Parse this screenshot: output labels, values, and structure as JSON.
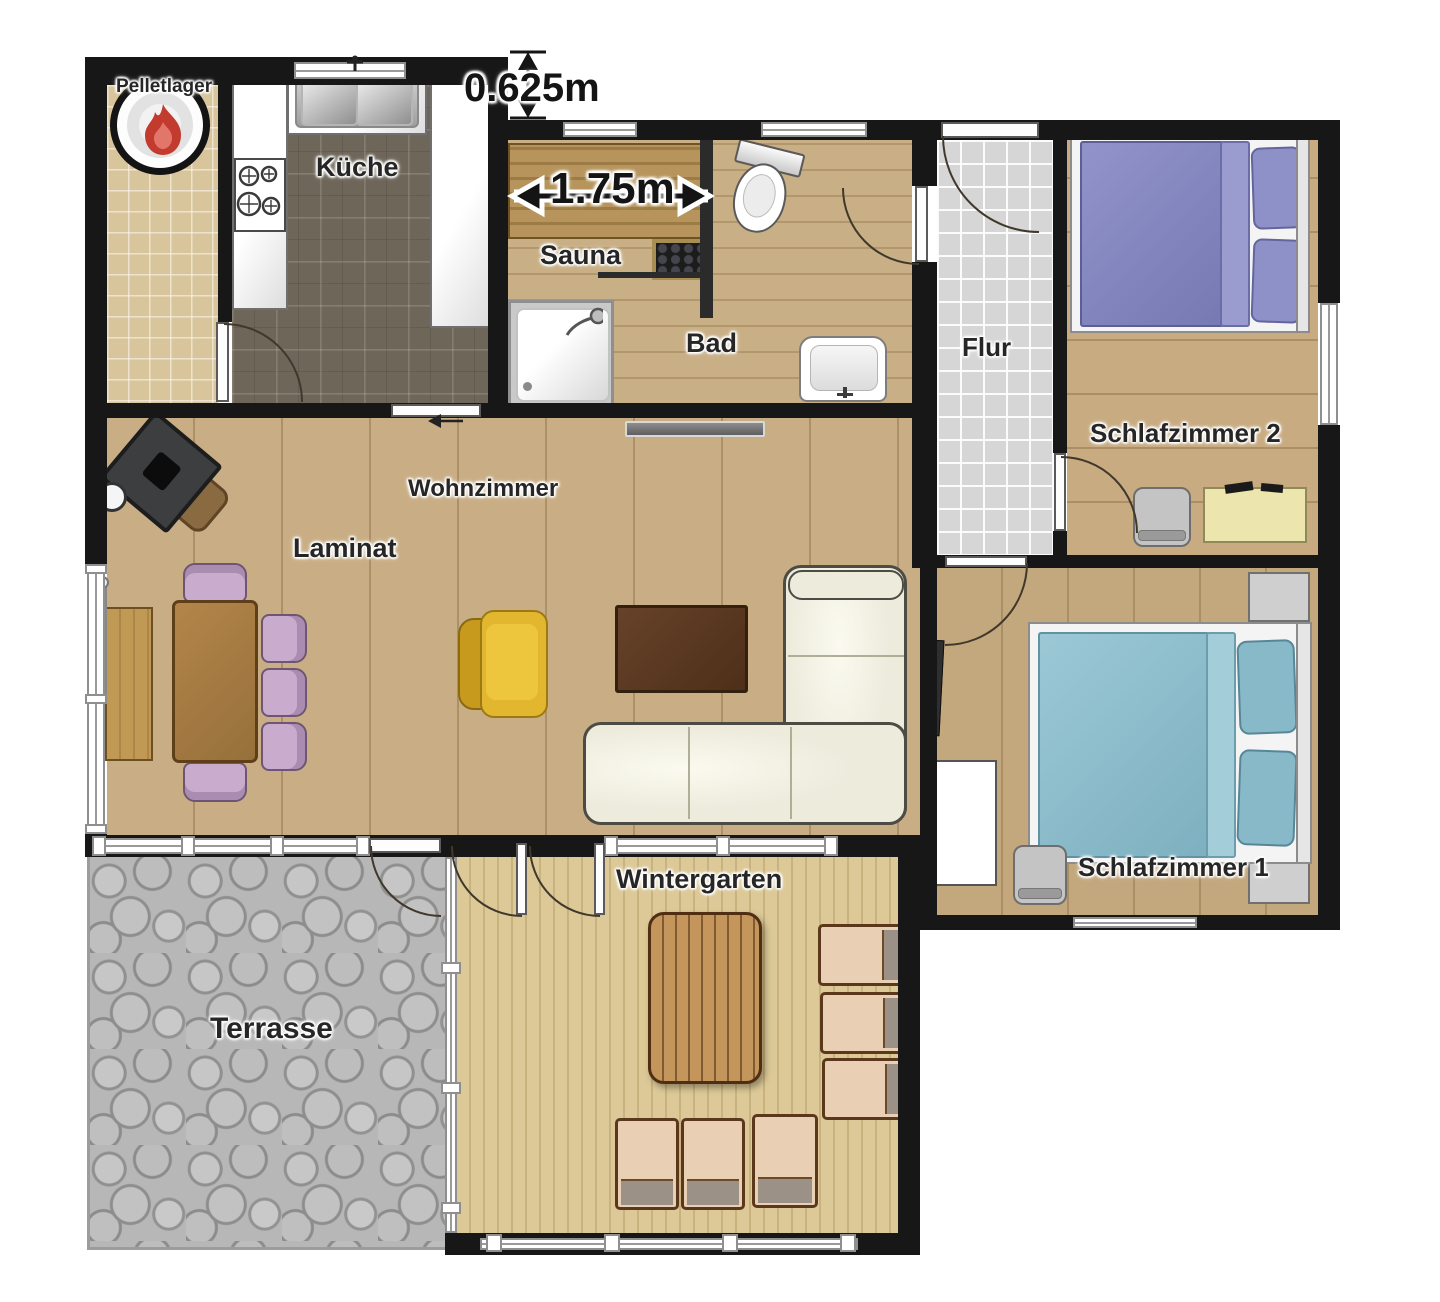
{
  "rooms": {
    "pelletlager": {
      "label": "Pelletlager"
    },
    "kueche": {
      "label": "Küche"
    },
    "sauna": {
      "label": "Sauna"
    },
    "bad": {
      "label": "Bad"
    },
    "flur": {
      "label": "Flur"
    },
    "schlafzimmer2": {
      "label": "Schlafzimmer 2"
    },
    "schlafzimmer1": {
      "label": "Schlafzimmer 1"
    },
    "wohnzimmer": {
      "label": "Wohnzimmer",
      "floor_label": "Laminat"
    },
    "wintergarten": {
      "label": "Wintergarten"
    },
    "terrasse": {
      "label": "Terrasse"
    }
  },
  "dimensions": {
    "wall_offset": "0.625m",
    "sauna_bench_width": "1.75m"
  },
  "furniture": {
    "pelletlager": [
      "pellet-stove-icon"
    ],
    "kueche": [
      "kitchen-counter-left",
      "cooktop-icon",
      "kitchen-sink-icon",
      "kitchen-counter-right",
      "sliding-door"
    ],
    "sauna": [
      "sauna-bench",
      "sauna-heater-icon"
    ],
    "bad": [
      "toilet-icon",
      "shower-icon",
      "washbasin-icon"
    ],
    "flur": [
      "entry-door"
    ],
    "schlafzimmer2": [
      "double-bed-purple",
      "chair",
      "desk"
    ],
    "schlafzimmer1": [
      "double-bed-blue",
      "nightstand-top",
      "nightstand-bottom",
      "wall-tv-icon",
      "wardrobe",
      "chair"
    ],
    "wohnzimmer": [
      "wood-stove-icon",
      "dining-bench",
      "dining-table",
      "dining-chairs-purple",
      "radiator",
      "armchair-yellow",
      "coffee-table",
      "corner-sofa",
      "wall-radiator"
    ],
    "wintergarten": [
      "garden-table",
      "garden-chairs-right",
      "garden-chairs-bottom"
    ],
    "terrasse": []
  },
  "colors": {
    "wall": "#171717",
    "bed_purple": "#8486c0",
    "bed_blue": "#8fc0cf",
    "chair_purple": "#c9abce",
    "armchair_yellow": "#e2b62e",
    "sofa_cream": "#ecebdc",
    "dining_table_brown": "#a5793f",
    "coffee_table_brown": "#5d3a22",
    "desk_yellow": "#ece5ae",
    "garden_table_wood": "#c5965c",
    "flame_red": "#c23b2e",
    "laminate_wood": "#c9ae85",
    "kitchen_tile": "#6e6659",
    "flur_tile": "#d6d6d6",
    "terrace_stone": "#b7b7b7"
  }
}
